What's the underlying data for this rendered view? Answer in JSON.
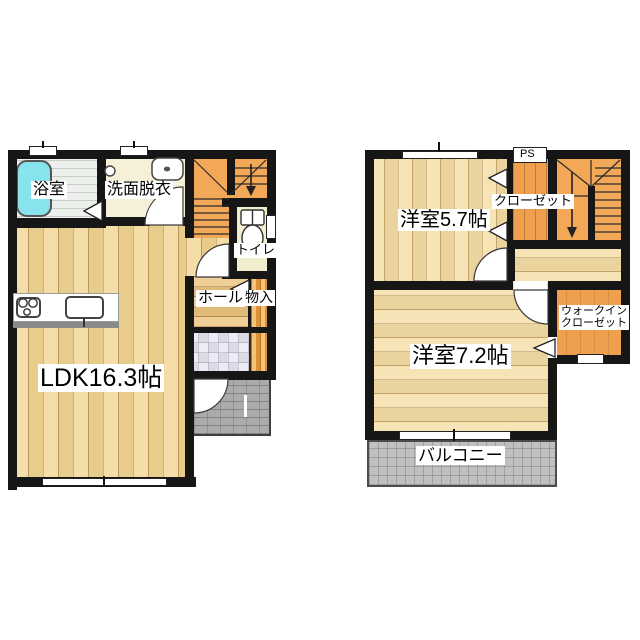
{
  "colors": {
    "wall": "#161616",
    "wood": "#f2d592",
    "wood-light": "#f4dca4",
    "hall-wood": "#ecc57e",
    "stairs-orange": "#f2a857",
    "closet-orange": "#efa04e",
    "tub-cyan": "#87e3ec",
    "bath-tile": "#edf0ec",
    "washroom-cream": "#f6f0d8",
    "toilet-cream": "#f1eecd",
    "porch-gray": "#ababab",
    "balcony-gray": "#c0c0c0"
  },
  "floor1": {
    "labels": {
      "bath": "浴室",
      "washroom": "洗面脱衣",
      "toilet": "トイレ",
      "hall": "ホール",
      "storage": "物入",
      "ldk": "LDK16.3帖"
    }
  },
  "floor2": {
    "labels": {
      "bedroom1": "洋室5.7帖",
      "closet": "クローゼット",
      "ps": "PS",
      "bedroom2": "洋室7.2帖",
      "wic_line1": "ウォークイン",
      "wic_line2": "クローゼット",
      "balcony": "バルコニー"
    }
  }
}
